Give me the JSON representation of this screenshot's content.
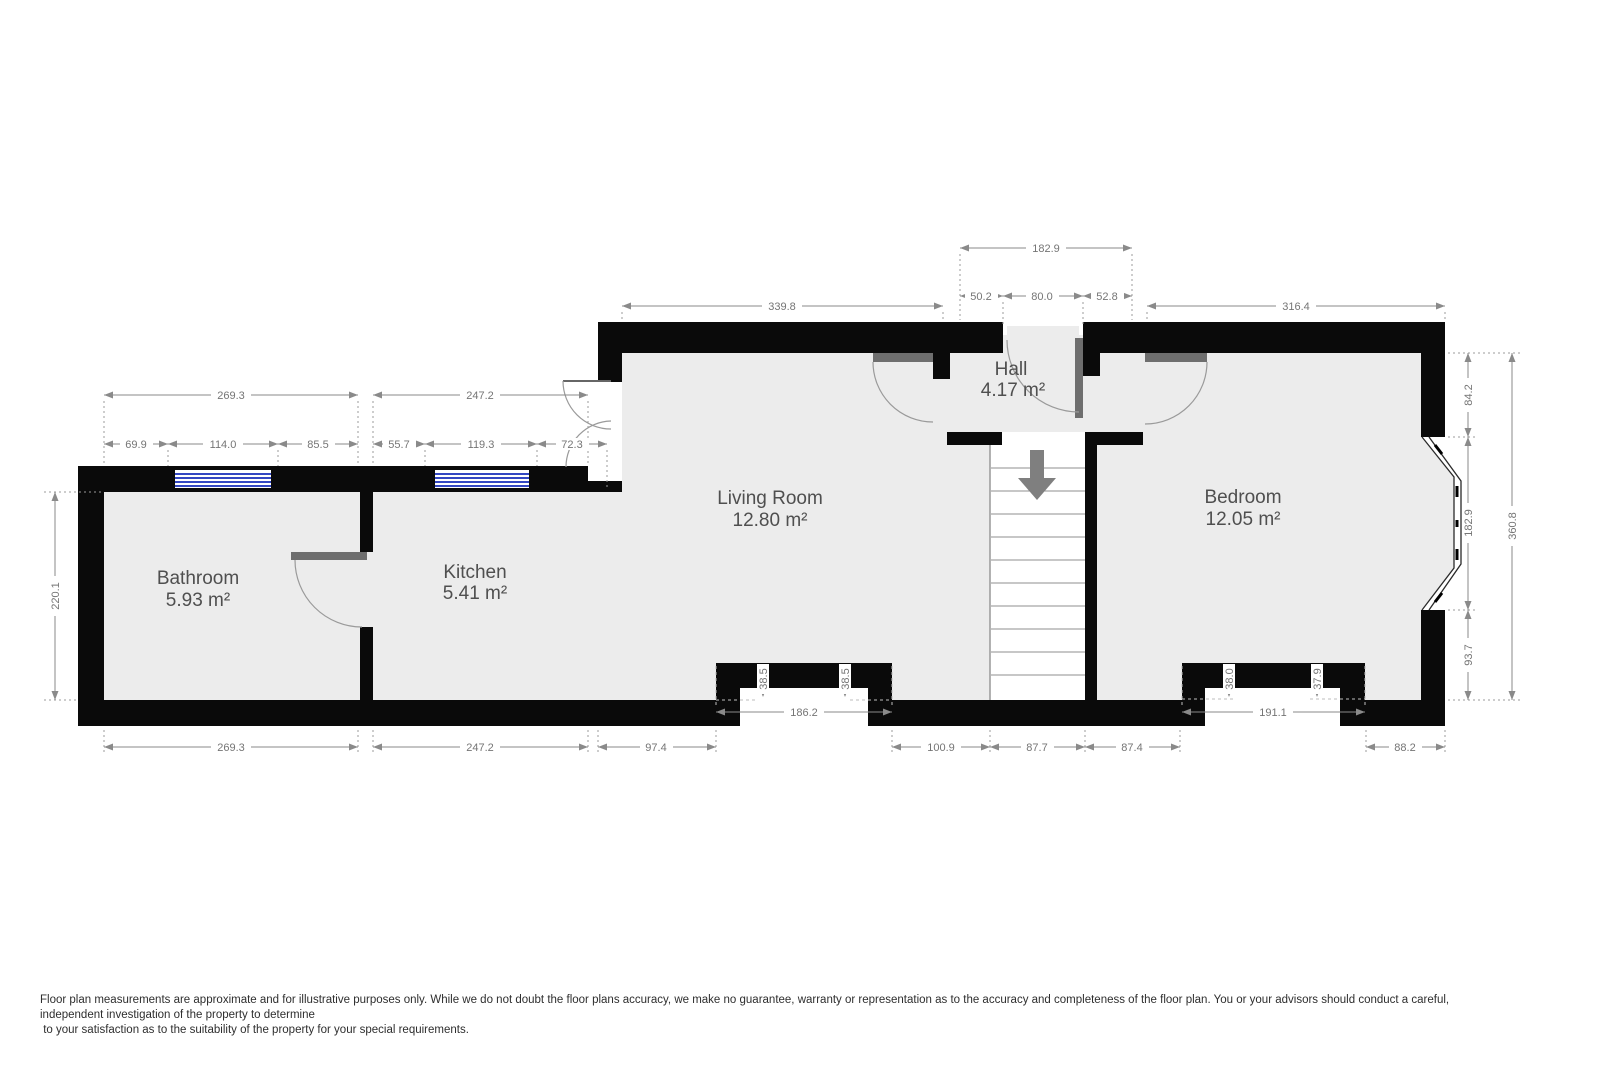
{
  "rooms": {
    "bathroom": {
      "name": "Bathroom",
      "area": "5.93 m²"
    },
    "kitchen": {
      "name": "Kitchen",
      "area": "5.41 m²"
    },
    "living": {
      "name": "Living Room",
      "area": "12.80 m²"
    },
    "hall": {
      "name": "Hall",
      "area": "4.17 m²"
    },
    "bedroom": {
      "name": "Bedroom",
      "area": "12.05 m²"
    }
  },
  "dimensions": {
    "top_hall_total": "182.9",
    "top_hall_left": "50.2",
    "top_hall_door": "80.0",
    "top_hall_right": "52.8",
    "top_living": "339.8",
    "top_bedroom": "316.4",
    "top_bathroom": "269.3",
    "top_kitchen": "247.2",
    "bathroom_seg_left": "69.9",
    "bathroom_window": "114.0",
    "bathroom_seg_right": "85.5",
    "kitchen_seg_left": "55.7",
    "kitchen_window": "119.3",
    "kitchen_seg_right": "72.3",
    "left_bathroom_height": "220.1",
    "right_upper": "84.2",
    "right_bay": "182.9",
    "right_lower": "93.7",
    "right_total": "360.8",
    "living_recess_width": "186.2",
    "living_recess_depth_left": "38.5",
    "living_recess_depth_right": "38.5",
    "bedroom_recess_width": "191.1",
    "bedroom_recess_depth_left": "38.0",
    "bedroom_recess_depth_right": "37.9",
    "bottom_bathroom": "269.3",
    "bottom_kitchen": "247.2",
    "bottom_living_left": "97.4",
    "bottom_living_right": "100.9",
    "bottom_stairs": "87.7",
    "bottom_hall": "87.4",
    "bottom_bedroom": "88.2"
  },
  "disclaimer": {
    "line1": "Floor plan measurements are approximate and for illustrative purposes only. While we do not doubt the floor plans accuracy, we make no guarantee, warranty or representation as to the accuracy and completeness of the floor plan. You or your advisors should conduct a careful, independent investigation of the property to determine",
    "line2": " to your satisfaction as to the suitability of the property for your special requirements."
  },
  "colors": {
    "wall": "#0a0a0a",
    "floor": "#ececec",
    "window_glass": "#3347c2",
    "dimension": "#8a8a8a",
    "door": "#6e6e6e"
  }
}
